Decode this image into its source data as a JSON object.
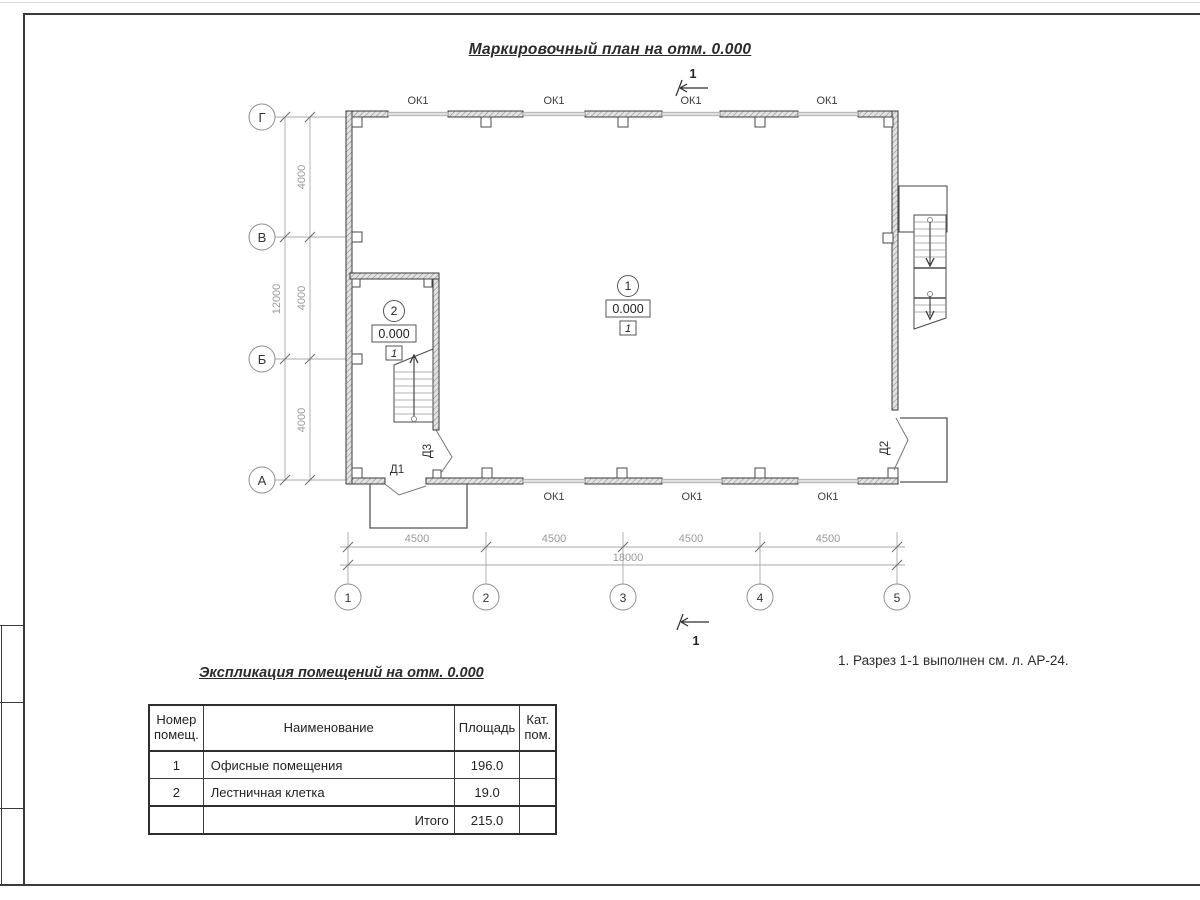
{
  "sheet": {
    "title": "Маркировочный план на отм. 0.000",
    "note": "1. Разрез 1-1 выполнен см. л. АР-24."
  },
  "plan": {
    "window_label": "ОК1",
    "section_label": "1",
    "doors": {
      "d1": "Д1",
      "d2": "Д2",
      "d3": "Д3"
    },
    "rooms": [
      {
        "number": "1",
        "elevation": "0.000",
        "floor_type": "1"
      },
      {
        "number": "2",
        "elevation": "0.000",
        "floor_type": "1"
      }
    ],
    "axes": {
      "vertical": [
        "Г",
        "В",
        "Б",
        "А"
      ],
      "horizontal": [
        "1",
        "2",
        "3",
        "4",
        "5"
      ]
    },
    "dims": {
      "bay": "4500",
      "total_width": "18000",
      "row": "4000",
      "total_depth": "12000"
    }
  },
  "table": {
    "title": "Экспликация помещений на отм. 0.000",
    "headers": {
      "number": "Номер помещ.",
      "name": "Наименование",
      "area": "Площадь",
      "category": "Кат. пом."
    },
    "rows": [
      {
        "number": "1",
        "name": "Офисные помещения",
        "area": "196.0",
        "category": ""
      },
      {
        "number": "2",
        "name": "Лестничная клетка",
        "area": "19.0",
        "category": ""
      }
    ],
    "total_label": "Итого",
    "total_area": "215.0"
  }
}
